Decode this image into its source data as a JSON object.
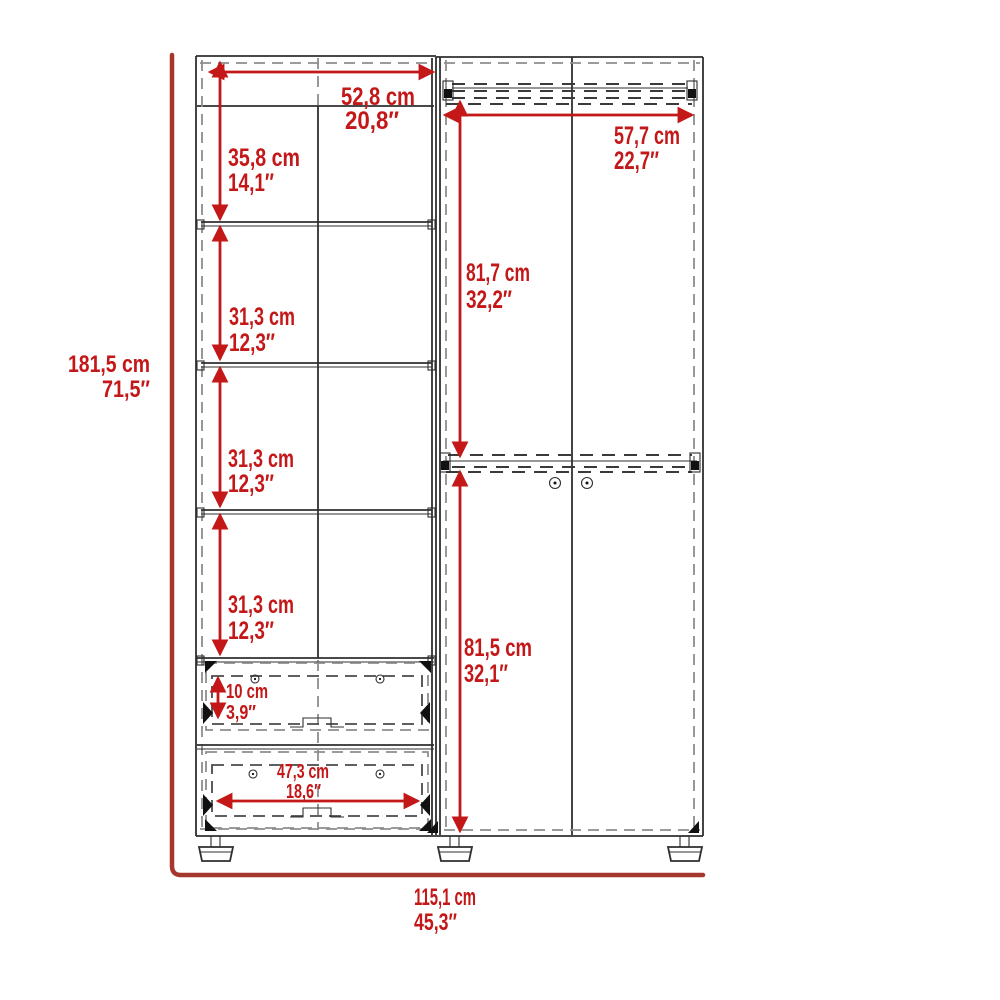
{
  "diagram": {
    "type": "wardrobe-dimension-diagram",
    "colors": {
      "dimension_red": "#c31718",
      "frame_red": "#a5372e",
      "outline_dark": "#2f2f2f",
      "dash_gray": "#8d8d8d"
    },
    "dimensions": {
      "overall_height": {
        "cm": "181,5 cm",
        "in": "71,5″"
      },
      "overall_width": {
        "cm": "115,1 cm",
        "in": "45,3″"
      },
      "left_top_width": {
        "cm": "52,8 cm",
        "in": "20,8″"
      },
      "left_top_section": {
        "cm": "35,8 cm",
        "in": "14,1″"
      },
      "left_shelf_section_1": {
        "cm": "31,3 cm",
        "in": "12,3″"
      },
      "left_shelf_section_2": {
        "cm": "31,3 cm",
        "in": "12,3″"
      },
      "left_shelf_section_3": {
        "cm": "31,3 cm",
        "in": "12,3″"
      },
      "drawer_height": {
        "cm": "10 cm",
        "in": "3,9″"
      },
      "drawer_width": {
        "cm": "47,3 cm",
        "in": "18,6″"
      },
      "right_width": {
        "cm": "57,7 cm",
        "in": "22,7″"
      },
      "right_upper_section": {
        "cm": "81,7 cm",
        "in": "32,2″"
      },
      "right_lower_section": {
        "cm": "81,5 cm",
        "in": "32,1″"
      }
    }
  }
}
